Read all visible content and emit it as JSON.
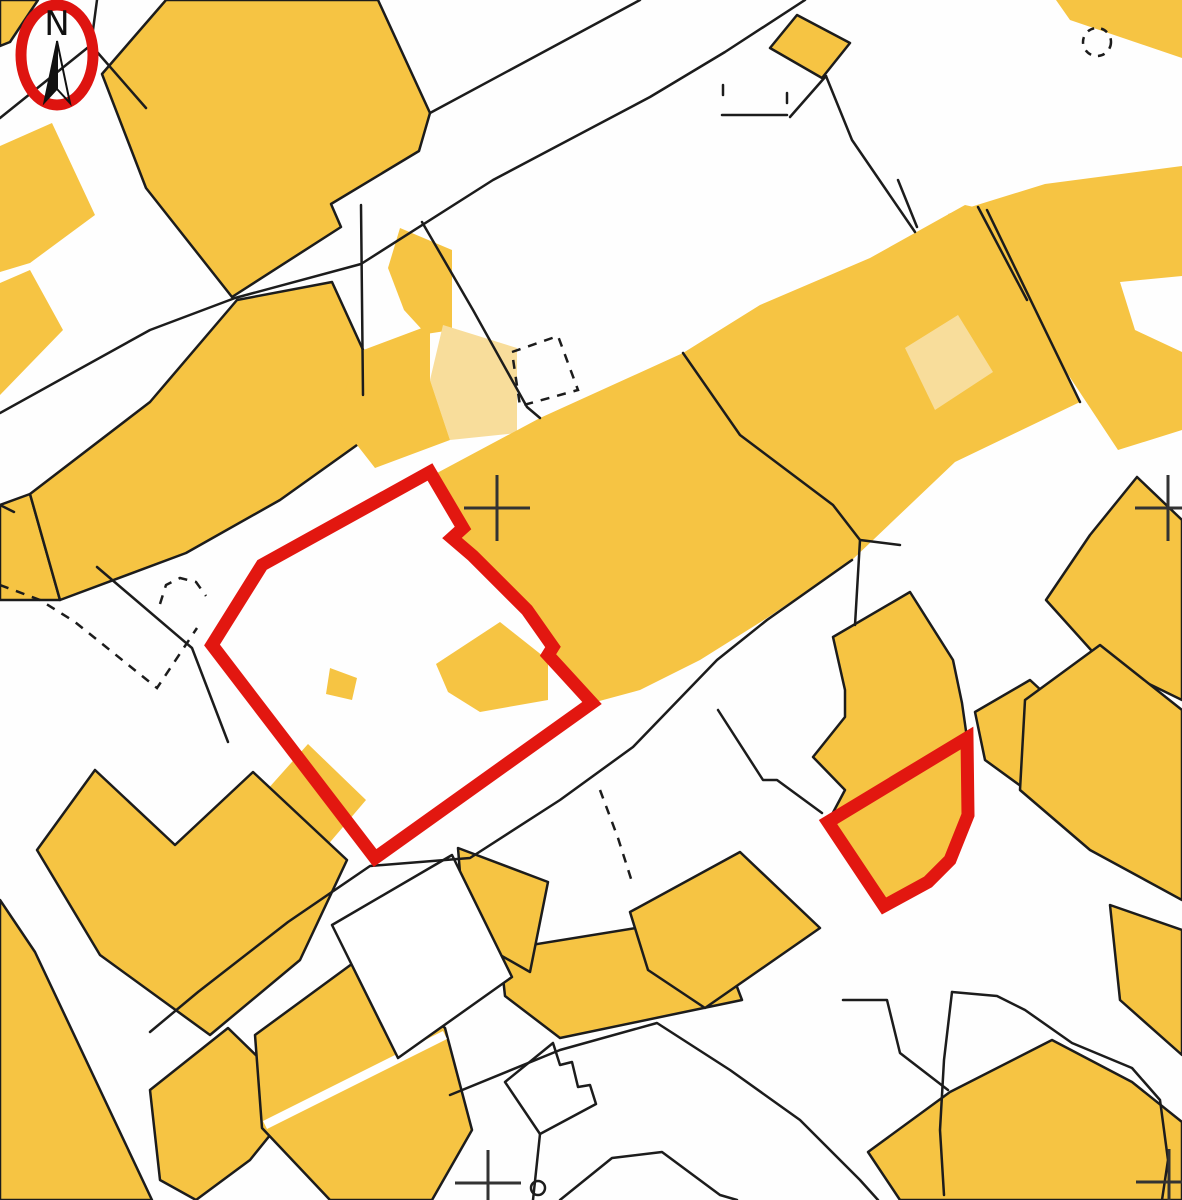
{
  "map": {
    "kind_label": "cadastral-parcel-plan",
    "width": 1182,
    "height": 1200,
    "colors": {
      "background": "#fefefe",
      "parcel_fill": "#F6C443",
      "parcel_fill_light": "#F8DD9B",
      "boundary_line": "#1c1c1c",
      "highlight_outline": "#E21710",
      "compass_ring": "#DE1410",
      "cross_mark": "#333333"
    },
    "compass": {
      "label": "N",
      "cx": 57,
      "cy": 55,
      "rx": 36,
      "ry": 50,
      "ring_width": 11
    },
    "buildings": [
      {
        "id": "bldg-tl-corner",
        "points": "0,0 38,0 10,42 0,46",
        "outline": true,
        "light": false
      },
      {
        "id": "bldg-a-large-nw",
        "points": "166,0 378,0 430,113 419,151 331,204 341,227 232,297 146,188 102,74",
        "outline": true,
        "light": false
      },
      {
        "id": "bldg-left-wedge-1",
        "points": "0,146 52,123 95,215 30,263 0,272",
        "outline": false,
        "light": false
      },
      {
        "id": "bldg-left-wedge-2",
        "points": "0,283 30,270 63,330 0,395",
        "outline": false,
        "light": false
      },
      {
        "id": "bldg-diamond",
        "points": "797,15 850,43 822,78 770,48",
        "outline": true,
        "light": false
      },
      {
        "id": "bldg-tr-band",
        "points": "1056,0 1182,0 1182,58 1070,20",
        "outline": false,
        "light": false
      },
      {
        "id": "bldg-right-sweep",
        "points": "948,214 1045,184 1182,166 1182,276 1120,282 1135,330 1182,352 1182,430 1118,450 1040,332 982,252",
        "outline": false,
        "light": false
      },
      {
        "id": "bldg-left-block-a",
        "points": "0,505 30,494 60,600 0,600",
        "outline": true,
        "light": false
      },
      {
        "id": "bldg-left-block-b",
        "points": "30,494 150,402 237,300 332,282 364,352 364,440 280,500 186,553 60,600",
        "outline": true,
        "light": false
      },
      {
        "id": "bldg-strip",
        "points": "400,228 452,250 452,330 426,334 404,310 388,268",
        "outline": false,
        "light": false
      },
      {
        "id": "bldg-light-patch-w",
        "points": "443,325 517,348 517,433 450,440 430,380",
        "outline": false,
        "light": true
      },
      {
        "id": "bldg-next-to-light",
        "points": "358,352 430,325 430,380 450,440 375,468 336,418",
        "outline": false,
        "light": false
      },
      {
        "id": "bldg-central-band",
        "points": "437,473 540,418 683,353 760,305 870,258 965,205 987,210 1080,402 955,462 852,560 767,618 700,660 640,690 592,703 560,668 548,655 553,647 527,610 478,556 452,538 463,528",
        "outline": false,
        "light": false
      },
      {
        "id": "bldg-light-patch-e",
        "points": "905,348 958,315 993,372 935,410",
        "outline": false,
        "light": true
      },
      {
        "id": "bldg-inside-red1",
        "points": "436,664 500,622 548,660 548,700 480,712 448,692",
        "outline": false,
        "light": false
      },
      {
        "id": "bldg-small-square-red1",
        "points": "330,668 357,678 352,700 326,694",
        "outline": false,
        "light": false
      },
      {
        "id": "bldg-sw-inside-red1",
        "points": "258,800 308,744 366,800 308,868",
        "outline": false,
        "light": false
      },
      {
        "id": "bldg-around-red2",
        "points": "833,637 910,592 953,660 962,703 967,738 968,815 950,860 928,882 884,906 828,822 845,790 813,757 845,717 845,690",
        "outline": true,
        "light": false
      },
      {
        "id": "bldg-ne-of-red2",
        "points": "975,712 1030,680 1095,740 1040,800 985,760",
        "outline": true,
        "light": false
      },
      {
        "id": "bldg-right-apex",
        "points": "1137,477 1182,520 1182,700 1100,660 1046,600 1090,535",
        "outline": true,
        "light": false
      },
      {
        "id": "bldg-right-mid",
        "points": "1025,700 1100,645 1182,710 1182,900 1090,850 1020,790",
        "outline": true,
        "light": false
      },
      {
        "id": "bldg-right-low",
        "points": "1110,905 1182,930 1182,1055 1120,1000",
        "outline": true,
        "light": false
      },
      {
        "id": "bldg-bl-corner",
        "points": "0,900 35,952 152,1200 0,1200",
        "outline": true,
        "light": false
      },
      {
        "id": "bldg-w-mass",
        "points": "95,770 175,845 253,772 347,860 300,960 210,1035 100,955 37,850",
        "outline": true,
        "light": false
      },
      {
        "id": "bldg-bl-mid",
        "points": "150,1090 228,1028 300,1098 250,1160 196,1200 160,1180",
        "outline": true,
        "light": false
      },
      {
        "id": "bldg-slash",
        "points": "255,1035 360,958 445,1028 472,1130 432,1200 330,1200 262,1128",
        "outline": true,
        "light": false
      },
      {
        "id": "bldg-bottom-center",
        "points": "500,950 710,916 742,1000 560,1038 505,996",
        "outline": true,
        "light": false
      },
      {
        "id": "bldg-br-mass",
        "points": "950,1092 1052,1040 1132,1082 1182,1122 1182,1200 900,1200 868,1152",
        "outline": true,
        "light": false
      },
      {
        "id": "bldg-center-low",
        "points": "630,912 740,852 820,928 705,1008 648,970",
        "outline": true,
        "light": false
      },
      {
        "id": "bldg-se-of-red1",
        "points": "458,848 548,882 530,972 465,935",
        "outline": true,
        "light": false
      }
    ],
    "white_parcels": [
      {
        "id": "parcel-stepped",
        "points": "505,1082 553,1043 560,1065 572,1062 578,1087 590,1085 596,1104 540,1134"
      },
      {
        "id": "parcel-white-quad",
        "points": "332,925 452,855 512,977 398,1058"
      }
    ],
    "boundary_lines": [
      {
        "id": "line-tl-a",
        "points": "97,0 91,45 0,118"
      },
      {
        "id": "line-tl-b",
        "points": "91,45 146,108"
      },
      {
        "id": "line-road1-upper",
        "points": "430,113 640,0"
      },
      {
        "id": "line-road1-lower",
        "points": "0,413 150,330 235,298 361,264 493,180 650,97 725,52 805,0"
      },
      {
        "id": "line-branch-se",
        "points": "422,222 473,310 527,407 540,418"
      },
      {
        "id": "line-vertical-strip",
        "points": "361,205 363,395"
      },
      {
        "id": "line-ticks-h",
        "points": "722,115 787,115"
      },
      {
        "id": "line-tick-1",
        "points": "723,85 723,95"
      },
      {
        "id": "line-tick-2",
        "points": "787,93 787,103"
      },
      {
        "id": "line-tick-link",
        "points": "790,117 826,76"
      },
      {
        "id": "line-diamond-se",
        "points": "826,76 852,140 915,232"
      },
      {
        "id": "line-sweep-cut",
        "points": "978,207 1027,300"
      },
      {
        "id": "line-band-cut-a",
        "points": "898,180 917,227"
      },
      {
        "id": "line-band-cut-b",
        "points": "987,210 1080,402"
      },
      {
        "id": "line-center-parcel",
        "points": "683,353 740,435 833,505 860,540 855,625"
      },
      {
        "id": "line-center-parcel-b",
        "points": "860,540 900,545"
      },
      {
        "id": "line-road3-upper",
        "points": "852,560 767,620 717,660 633,747 560,800 470,858 370,866 288,922 198,992 150,1032"
      },
      {
        "id": "line-to-red2",
        "points": "718,710 763,780 777,780 822,813"
      },
      {
        "id": "line-left-mid",
        "points": "97,567 192,648 228,742"
      },
      {
        "id": "line-left-edge-mark",
        "points": "0,505 14,512"
      },
      {
        "id": "line-br-fork-ne",
        "points": "952,992 997,996 1025,1010 1072,1043 1132,1068 1160,1100 1168,1160 1162,1200"
      },
      {
        "id": "line-br-fork-w",
        "points": "952,992 944,1060 940,1130 944,1195"
      },
      {
        "id": "line-road4-upper",
        "points": "450,1095 560,1050 657,1023 730,1070 800,1120 860,1180 878,1200"
      },
      {
        "id": "line-road4-lower",
        "points": "560,1200 612,1158 662,1152 720,1195 737,1200"
      },
      {
        "id": "line-road4-link",
        "points": "843,1000 887,1000 900,1053 948,1090"
      },
      {
        "id": "line-stepped-tail",
        "points": "540,1134 533,1200"
      }
    ],
    "dashed_lines": [
      {
        "id": "dash-v-left",
        "points": "0,585 40,600 75,622 157,688 197,628"
      },
      {
        "id": "dash-arc-left",
        "points": "160,604 166,585 180,578 196,582 206,596"
      },
      {
        "id": "dash-quad-center",
        "points": "512,352 558,336 578,390 520,406 512,352"
      },
      {
        "id": "dash-east-of-red1",
        "points": "600,790 618,838 633,885"
      }
    ],
    "dashed_circle": {
      "id": "dash-circle-tr",
      "cx": 1097,
      "cy": 42,
      "r": 14
    },
    "tree_symbol": {
      "cx": 538,
      "cy": 1188,
      "r": 7
    },
    "survey_crosses": [
      {
        "x": 497,
        "y": 508
      },
      {
        "x": 1168,
        "y": 508
      },
      {
        "x": 488,
        "y": 1183
      },
      {
        "x": 1169,
        "y": 1182
      }
    ],
    "cross_arm": 33,
    "highlight_parcels": [
      {
        "id": "highlighted-parcel-1",
        "points": "430,472 463,528 452,538 473,556 527,610 553,647 548,655 560,668 592,703 375,858 212,645 262,565"
      },
      {
        "id": "highlighted-parcel-2",
        "points": "967,738 968,815 950,860 928,882 884,906 828,822"
      }
    ],
    "highlight_width": 13,
    "slash_overlay": {
      "points": "265,1125 445,1035",
      "width": 9
    }
  }
}
